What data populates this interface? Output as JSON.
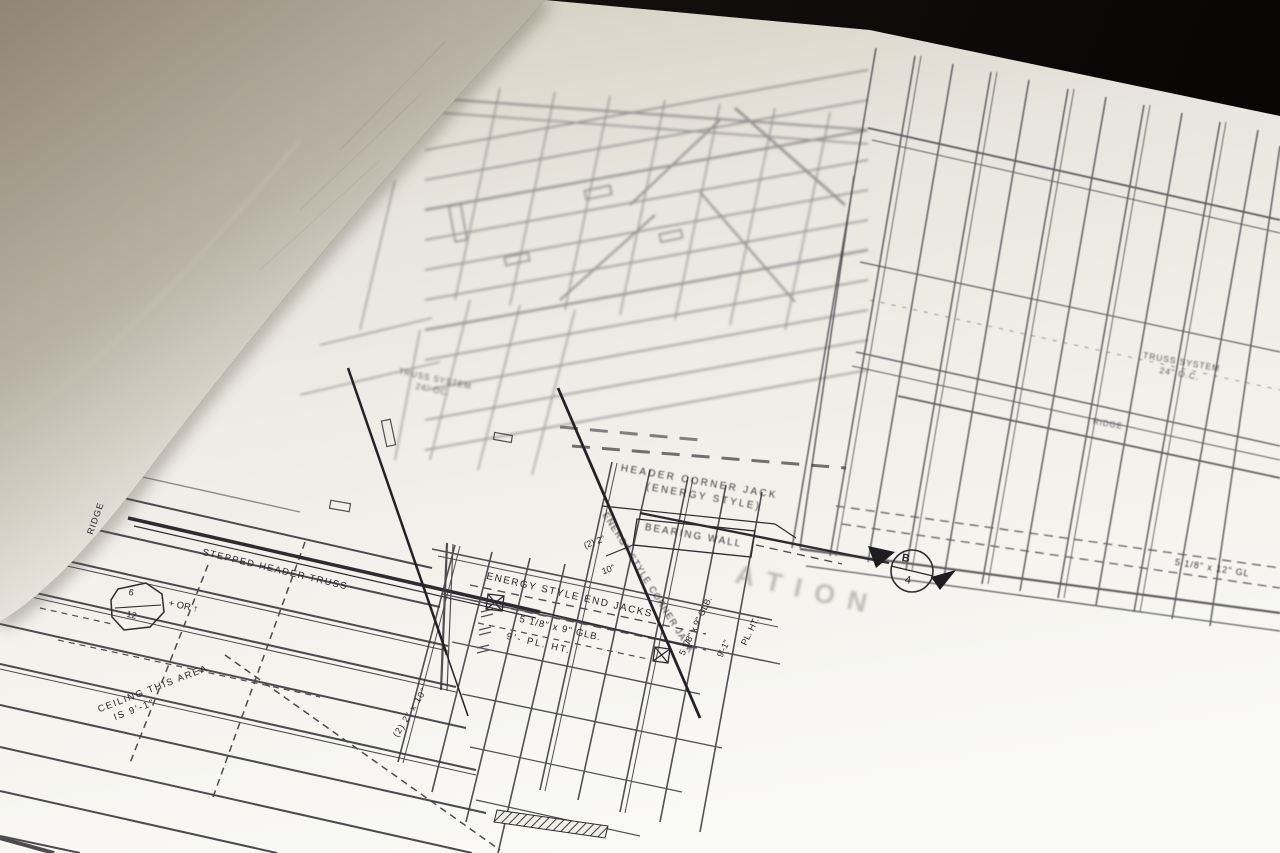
{
  "scene": {
    "subject": "rolled architectural blueprint framing plan photograph",
    "colors": {
      "background": "#0b0907",
      "paper": "#f1efe9",
      "curl_shadow": "#9a8d7a",
      "ink": "#2e2d33"
    }
  },
  "labels": {
    "header_corner_jack_1": "HEADER CORNER JACK",
    "header_corner_jack_2": "(ENERGY STYLE)",
    "bearing_wall": "BEARING WALL",
    "energy_style_end_jacks": "ENERGY STYLE END JACKS",
    "glb_note_1": "5 1/8\" x 9\" GLB.",
    "glb_note_2": "9'-   PL. HT.",
    "energy_style_corner_jack": "ENERGY STYLE CORNER JACK",
    "stepped_header_truss": "STEPPED HEADER TRUSS",
    "ridge_left": "RIDGE",
    "ridge_right": "RIDGE",
    "slope_top": "6",
    "slope_bottom": "12",
    "slope_suffix": "+ OR ↑",
    "ceiling_1": "CEILING THIS AREA",
    "ceiling_2": "IS 9'-1\"",
    "truss_left_1": "TRUSS SYSTEM",
    "truss_left_2": "24\" OC.",
    "truss_right_1": "TRUSS SYSTEM",
    "truss_right_2": "24\" O.C.",
    "glb_right": "5 1/8\"  x  12\" GL",
    "detail_letter": "B",
    "detail_number": "4",
    "note_2x2": "(2) 2\"",
    "note_10": "10\"",
    "note_2x2x10": "(2) 2\" x 10\"",
    "v_glb": "5 1/8\" x 9\" GLB.",
    "note_9ft": "9'-1\"",
    "note_pl_ht": "PL. HT.",
    "ghost_text": "ATION"
  }
}
